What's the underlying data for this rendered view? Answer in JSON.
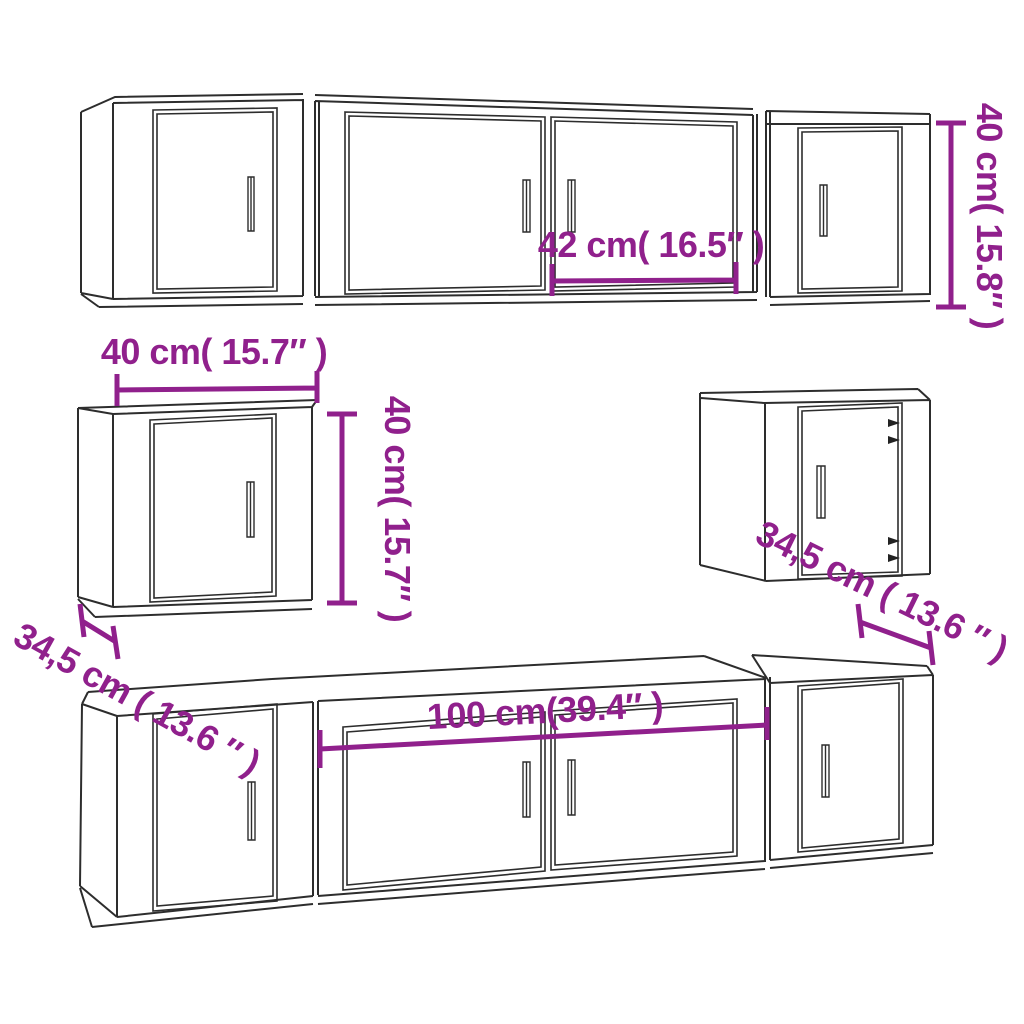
{
  "diagram": {
    "description": "Line drawing of an 8-piece wall-mounted TV cabinet set with dimension annotations",
    "colors": {
      "dimension_accent": "#90208C",
      "line": "#2D2D2D",
      "background": "#FFFFFF"
    },
    "dimensions": {
      "top_row_door_width": "42 cm( 16.5″ )",
      "top_row_height": "40 cm( 15.8″ )",
      "wall_cabinet_width": "40 cm( 15.7″ )",
      "wall_cabinet_height": "40 cm( 15.7″ )",
      "wall_cabinet_depth": "34,5 cm ( 13.6 ″ )",
      "side_cabinet_depth": "34,5 cm ( 13.6 ″ )",
      "tv_stand_width": "100 cm(39.4″ )"
    }
  }
}
